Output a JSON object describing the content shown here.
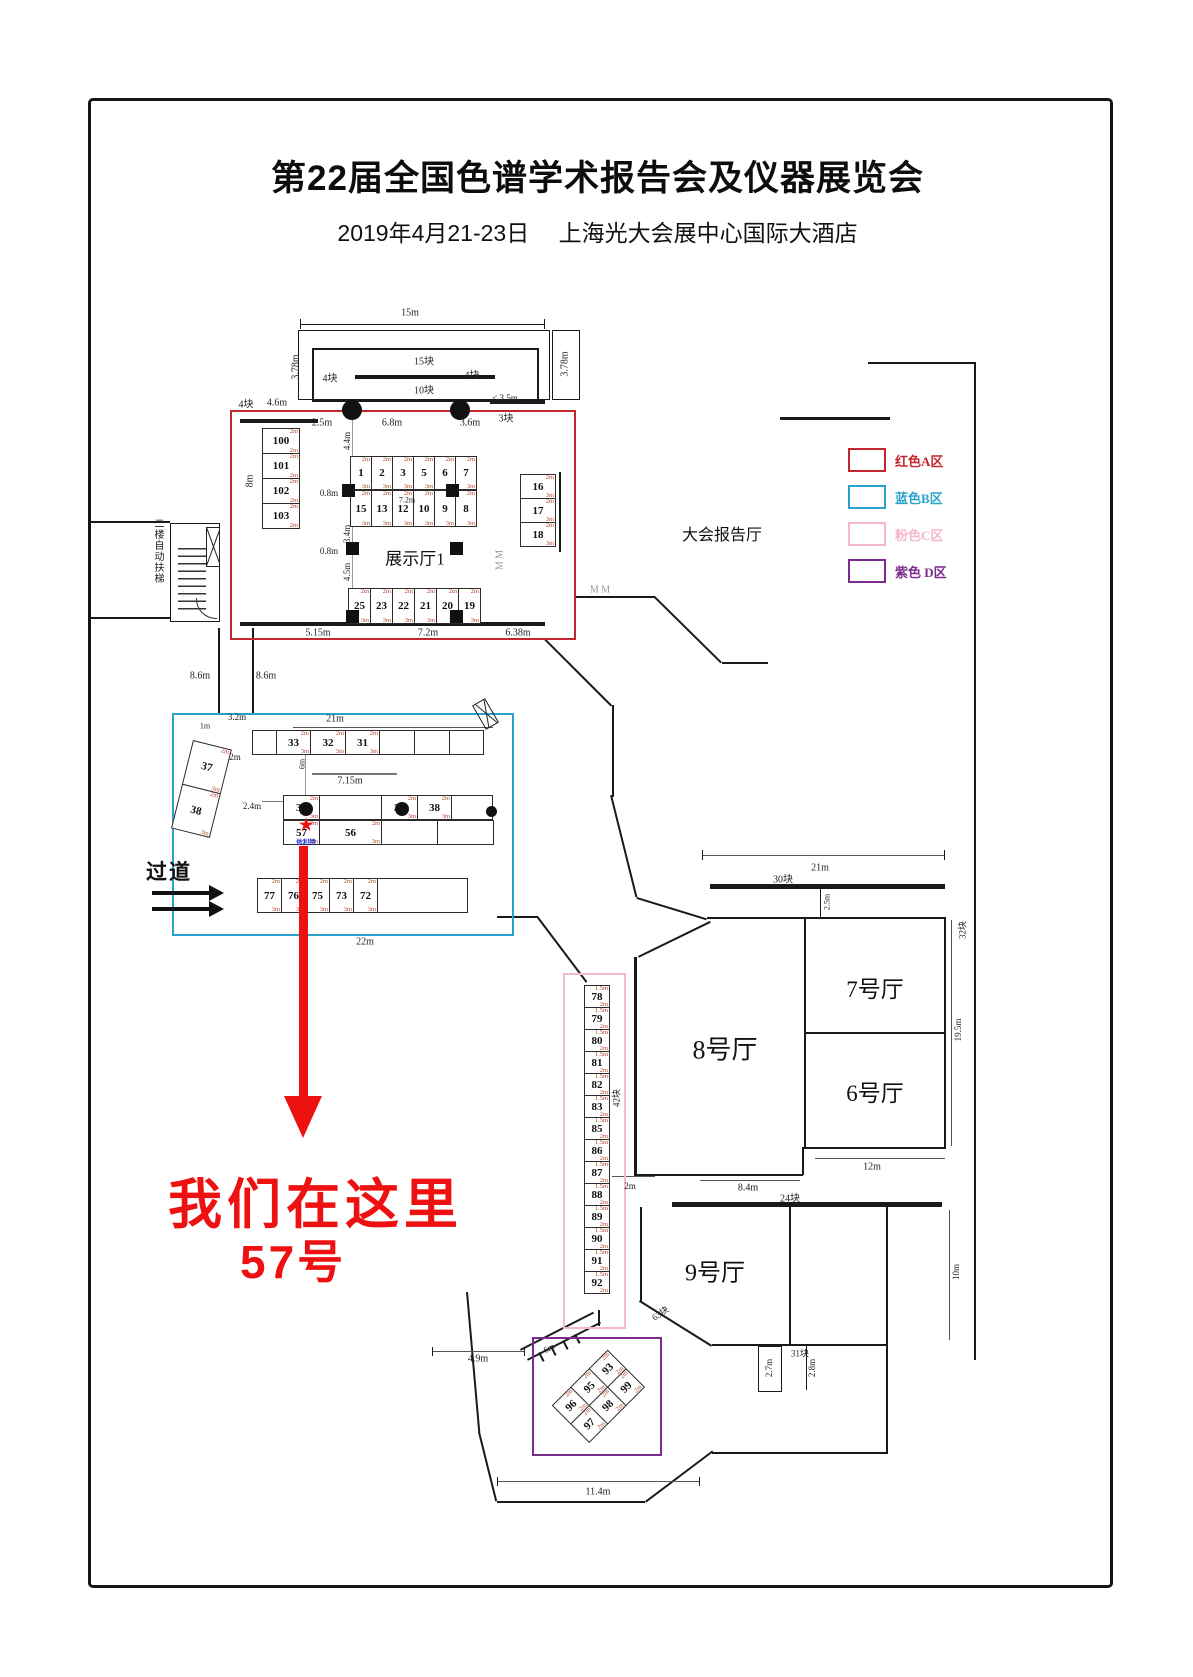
{
  "page": {
    "title": "第22届全国色谱学术报告会及仪器展览会",
    "subtitle": "2019年4月21-23日　 上海光大会展中心国际大酒店"
  },
  "legend": [
    {
      "label": "红色A区",
      "color": "#c1272d"
    },
    {
      "label": "蓝色B区",
      "color": "#29a3cc"
    },
    {
      "label": "粉色C区",
      "color": "#f4b8cc"
    },
    {
      "label": "紫色 D区",
      "color": "#7b2d8e"
    }
  ],
  "halls": {
    "exhibit1": "展示厅1",
    "report": "大会报告厅",
    "hall7": "7号厅",
    "hall6": "6号厅",
    "hall8": "8号厅",
    "hall9": "9号厅"
  },
  "texts": {
    "escalator": "二楼自动扶梯",
    "aisle": "过道",
    "we_are_here": "我们在这里",
    "booth_no": "57号",
    "star": "★",
    "company": "依利特"
  },
  "annotation": {
    "color": "#ee1111"
  },
  "zones": {
    "a": {
      "name": "红色A区",
      "color": "#c1272d",
      "col_left": [
        "100",
        "101",
        "102",
        "103"
      ],
      "row_top": [
        "1",
        "2",
        "3",
        "5",
        "6",
        "7"
      ],
      "row_mid": [
        "15",
        "13",
        "12",
        "10",
        "9",
        "8"
      ],
      "row_bottom": [
        "25",
        "23",
        "22",
        "21",
        "20",
        "19"
      ],
      "col_right": [
        "16",
        "17",
        "18"
      ],
      "sizes": {
        "top": "2m",
        "side": "3m"
      },
      "sizes_left": {
        "top": "2m",
        "side": "2m"
      }
    },
    "b": {
      "name": "蓝色B区",
      "color": "#29a3cc",
      "row_top": [
        "",
        "33",
        "32",
        "31",
        "",
        "",
        ""
      ],
      "angled": [
        "37",
        "38"
      ],
      "mid_row1": [
        "35",
        "",
        "37",
        "38",
        ""
      ],
      "mid_row2": [
        "57",
        "56",
        "",
        ""
      ],
      "row_bottom": [
        "77",
        "76",
        "75",
        "73",
        "72",
        ""
      ],
      "sizes": {
        "top": "2m",
        "side": "3m"
      }
    },
    "c": {
      "name": "粉色C区",
      "color": "#f4b8cc",
      "column": [
        "78",
        "79",
        "80",
        "81",
        "82",
        "83",
        "85",
        "86",
        "87",
        "88",
        "89",
        "90",
        "91",
        "92"
      ],
      "sizes": {
        "top": "1.5m",
        "side": "2m"
      }
    },
    "d": {
      "name": "紫色D区",
      "color": "#7b2d8e",
      "row1": [
        "96",
        "95",
        "93"
      ],
      "row2": [
        "97",
        "98",
        "99"
      ],
      "sizes": {
        "top": "2m",
        "side": "2m"
      }
    }
  },
  "labels": [
    {
      "t": "15m",
      "x": 410,
      "y": 313
    },
    {
      "t": "15块",
      "x": 424,
      "y": 360
    },
    {
      "t": "10块",
      "x": 424,
      "y": 389
    },
    {
      "t": "4块",
      "x": 330,
      "y": 377
    },
    {
      "t": "4块",
      "x": 472,
      "y": 374
    },
    {
      "t": "3.78m",
      "x": 296,
      "y": 367,
      "r": -90
    },
    {
      "t": "3.78m",
      "x": 565,
      "y": 364,
      "r": -90
    },
    {
      "t": "4块",
      "x": 246,
      "y": 403
    },
    {
      "t": "4.6m",
      "x": 277,
      "y": 403
    },
    {
      "t": "2.5m",
      "x": 322,
      "y": 423
    },
    {
      "t": "6.8m",
      "x": 392,
      "y": 423
    },
    {
      "t": "3.6m",
      "x": 470,
      "y": 423
    },
    {
      "t": "3块",
      "x": 506,
      "y": 417
    },
    {
      "t": "< 3.5m",
      "x": 505,
      "y": 398,
      "s": 9
    },
    {
      "t": "4.4m",
      "x": 347,
      "y": 441,
      "r": -90,
      "s": 9
    },
    {
      "t": "8m",
      "x": 250,
      "y": 481,
      "r": -90
    },
    {
      "t": "0.8m",
      "x": 329,
      "y": 493,
      "s": 9
    },
    {
      "t": "7.2m",
      "x": 407,
      "y": 500,
      "s": 8
    },
    {
      "t": "0.8m",
      "x": 329,
      "y": 551,
      "s": 9
    },
    {
      "t": "3.4m",
      "x": 347,
      "y": 534,
      "r": -90,
      "s": 9
    },
    {
      "t": "4.5m",
      "x": 347,
      "y": 572,
      "r": -90,
      "s": 9
    },
    {
      "t": "5.15m",
      "x": 318,
      "y": 633
    },
    {
      "t": "7.2m",
      "x": 428,
      "y": 633
    },
    {
      "t": "6.38m",
      "x": 518,
      "y": 633
    },
    {
      "t": "8.6m",
      "x": 200,
      "y": 676
    },
    {
      "t": "8.6m",
      "x": 266,
      "y": 676
    },
    {
      "t": "3.2m",
      "x": 237,
      "y": 717,
      "s": 9
    },
    {
      "t": "1m",
      "x": 205,
      "y": 726,
      "s": 8
    },
    {
      "t": "21m",
      "x": 335,
      "y": 719
    },
    {
      "t": "2m",
      "x": 235,
      "y": 757,
      "s": 9
    },
    {
      "t": "6m",
      "x": 302,
      "y": 764,
      "r": -90,
      "s": 8
    },
    {
      "t": "7.15m",
      "x": 350,
      "y": 781
    },
    {
      "t": "2.4m",
      "x": 252,
      "y": 806,
      "s": 9
    },
    {
      "t": "22m",
      "x": 365,
      "y": 942
    },
    {
      "t": "21m",
      "x": 820,
      "y": 868
    },
    {
      "t": "30块",
      "x": 783,
      "y": 878
    },
    {
      "t": "2.5m",
      "x": 827,
      "y": 902,
      "r": -90,
      "s": 8
    },
    {
      "t": "19.5m",
      "x": 958,
      "y": 1030,
      "r": -90,
      "s": 9
    },
    {
      "t": "12m",
      "x": 872,
      "y": 1167
    },
    {
      "t": "8.4m",
      "x": 748,
      "y": 1188
    },
    {
      "t": "24块",
      "x": 790,
      "y": 1197
    },
    {
      "t": "10m",
      "x": 956,
      "y": 1272,
      "r": -90,
      "s": 9
    },
    {
      "t": "31块",
      "x": 800,
      "y": 1353,
      "s": 9
    },
    {
      "t": "63块",
      "x": 660,
      "y": 1313,
      "r": -35,
      "s": 9
    },
    {
      "t": "2.7m",
      "x": 769,
      "y": 1368,
      "r": -90,
      "s": 9
    },
    {
      "t": "2.8m",
      "x": 812,
      "y": 1368,
      "r": -90,
      "s": 9
    },
    {
      "t": "32块",
      "x": 962,
      "y": 930,
      "r": -90,
      "s": 9
    },
    {
      "t": "42块",
      "x": 616,
      "y": 1098,
      "r": -90,
      "s": 9
    },
    {
      "t": "2m",
      "x": 630,
      "y": 1186,
      "s": 9
    },
    {
      "t": "4.9m",
      "x": 478,
      "y": 1359
    },
    {
      "t": "6m",
      "x": 549,
      "y": 1348,
      "r": -28,
      "s": 9
    },
    {
      "t": "11.4m",
      "x": 598,
      "y": 1492
    },
    {
      "t": "M M",
      "x": 500,
      "y": 560,
      "r": -90,
      "s": 10,
      "c": "#999"
    },
    {
      "t": "M M",
      "x": 600,
      "y": 590,
      "s": 10,
      "c": "#999"
    }
  ]
}
